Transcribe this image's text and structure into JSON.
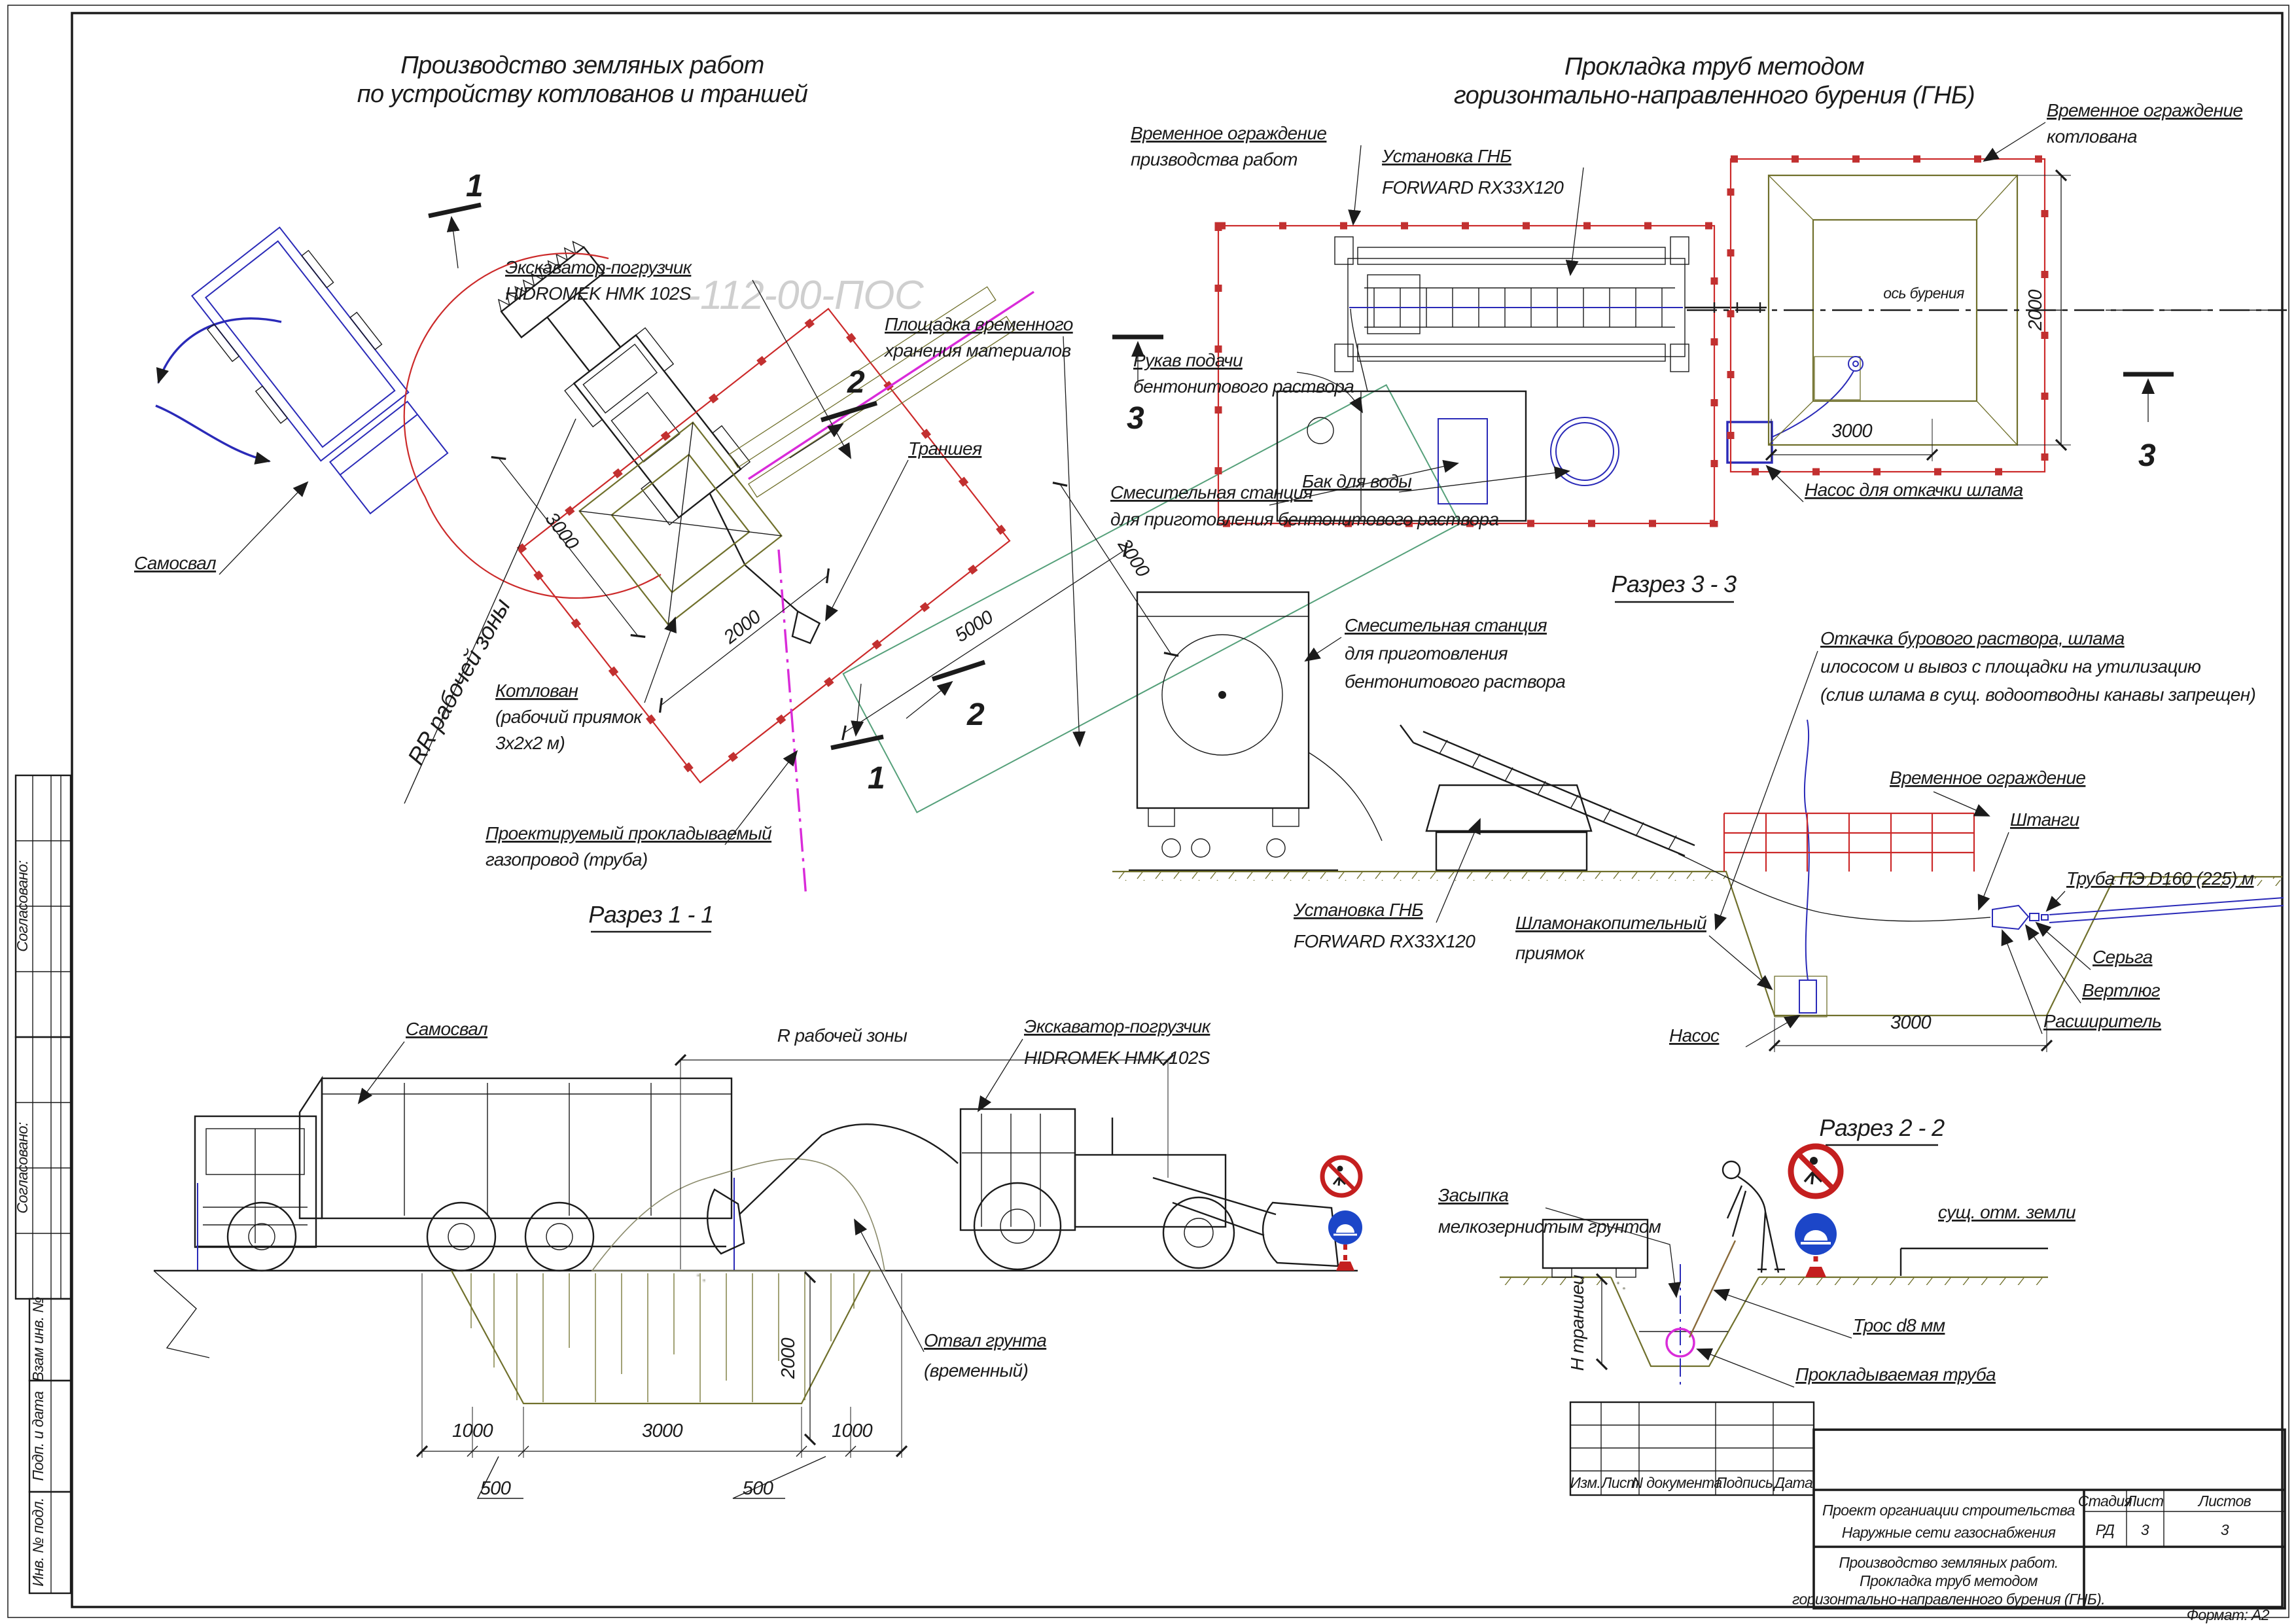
{
  "titles": {
    "plan_left": [
      "Производство земляных работ",
      "по устройству котлованов и траншей"
    ],
    "plan_right": [
      "Прокладка труб методом",
      "горизонтально-направленного бурения (ГНБ)"
    ]
  },
  "watermark": "-112-00-ПОС",
  "margin": {
    "approved1": "Согласовано:",
    "approved2": "Согласовано:",
    "cells": [
      "Взам инв. №",
      "Подп. и дата",
      "Инв. № подл."
    ]
  },
  "plan_left": {
    "labels": {
      "excavator": [
        "Экскаватор-погрузчик",
        "HIDROMEK HMK 102S"
      ],
      "storage": [
        "Площадка временного",
        "хранения материалов"
      ],
      "trench": "Траншея",
      "truck": "Самосвал",
      "pit": [
        "Котлован",
        "(рабочий приямок",
        "3х2х2 м)"
      ],
      "work_zone": "RR рабочей зоны",
      "gas_pipe": [
        "Проектируемый прокладываемый",
        "газопровод (труба)"
      ]
    },
    "dims": [
      "3000",
      "2000",
      "5000",
      "2000"
    ],
    "markers": [
      "1",
      "2"
    ]
  },
  "plan_right": {
    "labels": {
      "fence_works": [
        "Временное ограждение",
        "призводства работ"
      ],
      "rig": [
        "Установка ГНБ",
        "FORWARD RX33X120"
      ],
      "fence_pit": [
        "Временное ограждение",
        "котлована"
      ],
      "hose": [
        "Рукав подачи",
        "бентонитового раствора"
      ],
      "mixing": [
        "Смесительная станция",
        "для приготовления бентонитового раствора"
      ],
      "water_tank": "Бак для воды",
      "sludge_pump": "Насос для откачки шлама",
      "axis": "ось бурения"
    },
    "dims": [
      "3000",
      "2000"
    ],
    "marker": "3"
  },
  "section3": {
    "heading": "Разрез 3 - 3",
    "labels": {
      "mixing": [
        "Смесительная станция",
        "для приготовления",
        "бентонитового раствора"
      ],
      "removal": [
        "Откачка бурового раствора, шлама",
        "илососом и вывоз с площадки на утилизацию",
        "(слив шлама в сущ. водоотводны канавы запрещен)"
      ],
      "fence": "Временное ограждение",
      "rods": "Штанги",
      "pipe": "Труба ПЭ D160 (225) м",
      "shackle": "Серьга",
      "swivel": "Вертлюг",
      "reamer": "Расширитель",
      "rig": [
        "Установка ГНБ",
        "FORWARD RX33X120"
      ],
      "sump": [
        "Шламонакопительный",
        "приямок"
      ],
      "pump": "Насос"
    },
    "dim": "3000"
  },
  "section1": {
    "heading": "Разрез 1 - 1",
    "labels": {
      "truck": "Самосвал",
      "radius": "R рабочей зоны",
      "excavator": [
        "Экскаватор-погрузчик",
        "HIDROMEK HMK 102S"
      ],
      "spoil": [
        "Отвал грунта",
        "(временный)"
      ]
    },
    "dims": [
      "1000",
      "3000",
      "1000",
      "500",
      "500",
      "2000"
    ]
  },
  "section2": {
    "heading": "Разрез 2 - 2",
    "labels": {
      "backfill": [
        "Засыпка",
        "мелкозернистым грунтом"
      ],
      "ground": "сущ. отм. земли",
      "depth": "Н траншеи",
      "cable": "Трос d8 мм",
      "pipe": "Прокладываемая труба"
    }
  },
  "title_block": {
    "rev_headers": [
      "Изм.",
      "Лист",
      "N документа",
      "Подпись",
      "Дата"
    ],
    "project": [
      "Проект органиации строительства",
      "Наружные сети газоснабжения"
    ],
    "stage_label": "Стадия",
    "sheet_label": "Лист",
    "sheets_label": "Листов",
    "stage": "РД",
    "sheet": "3",
    "sheets": "3",
    "doc_title": [
      "Производство земляных работ.",
      "Прокладка труб методом",
      "горизонтально-направленного бурения (ГНБ)."
    ],
    "format": "Формат: А2"
  }
}
